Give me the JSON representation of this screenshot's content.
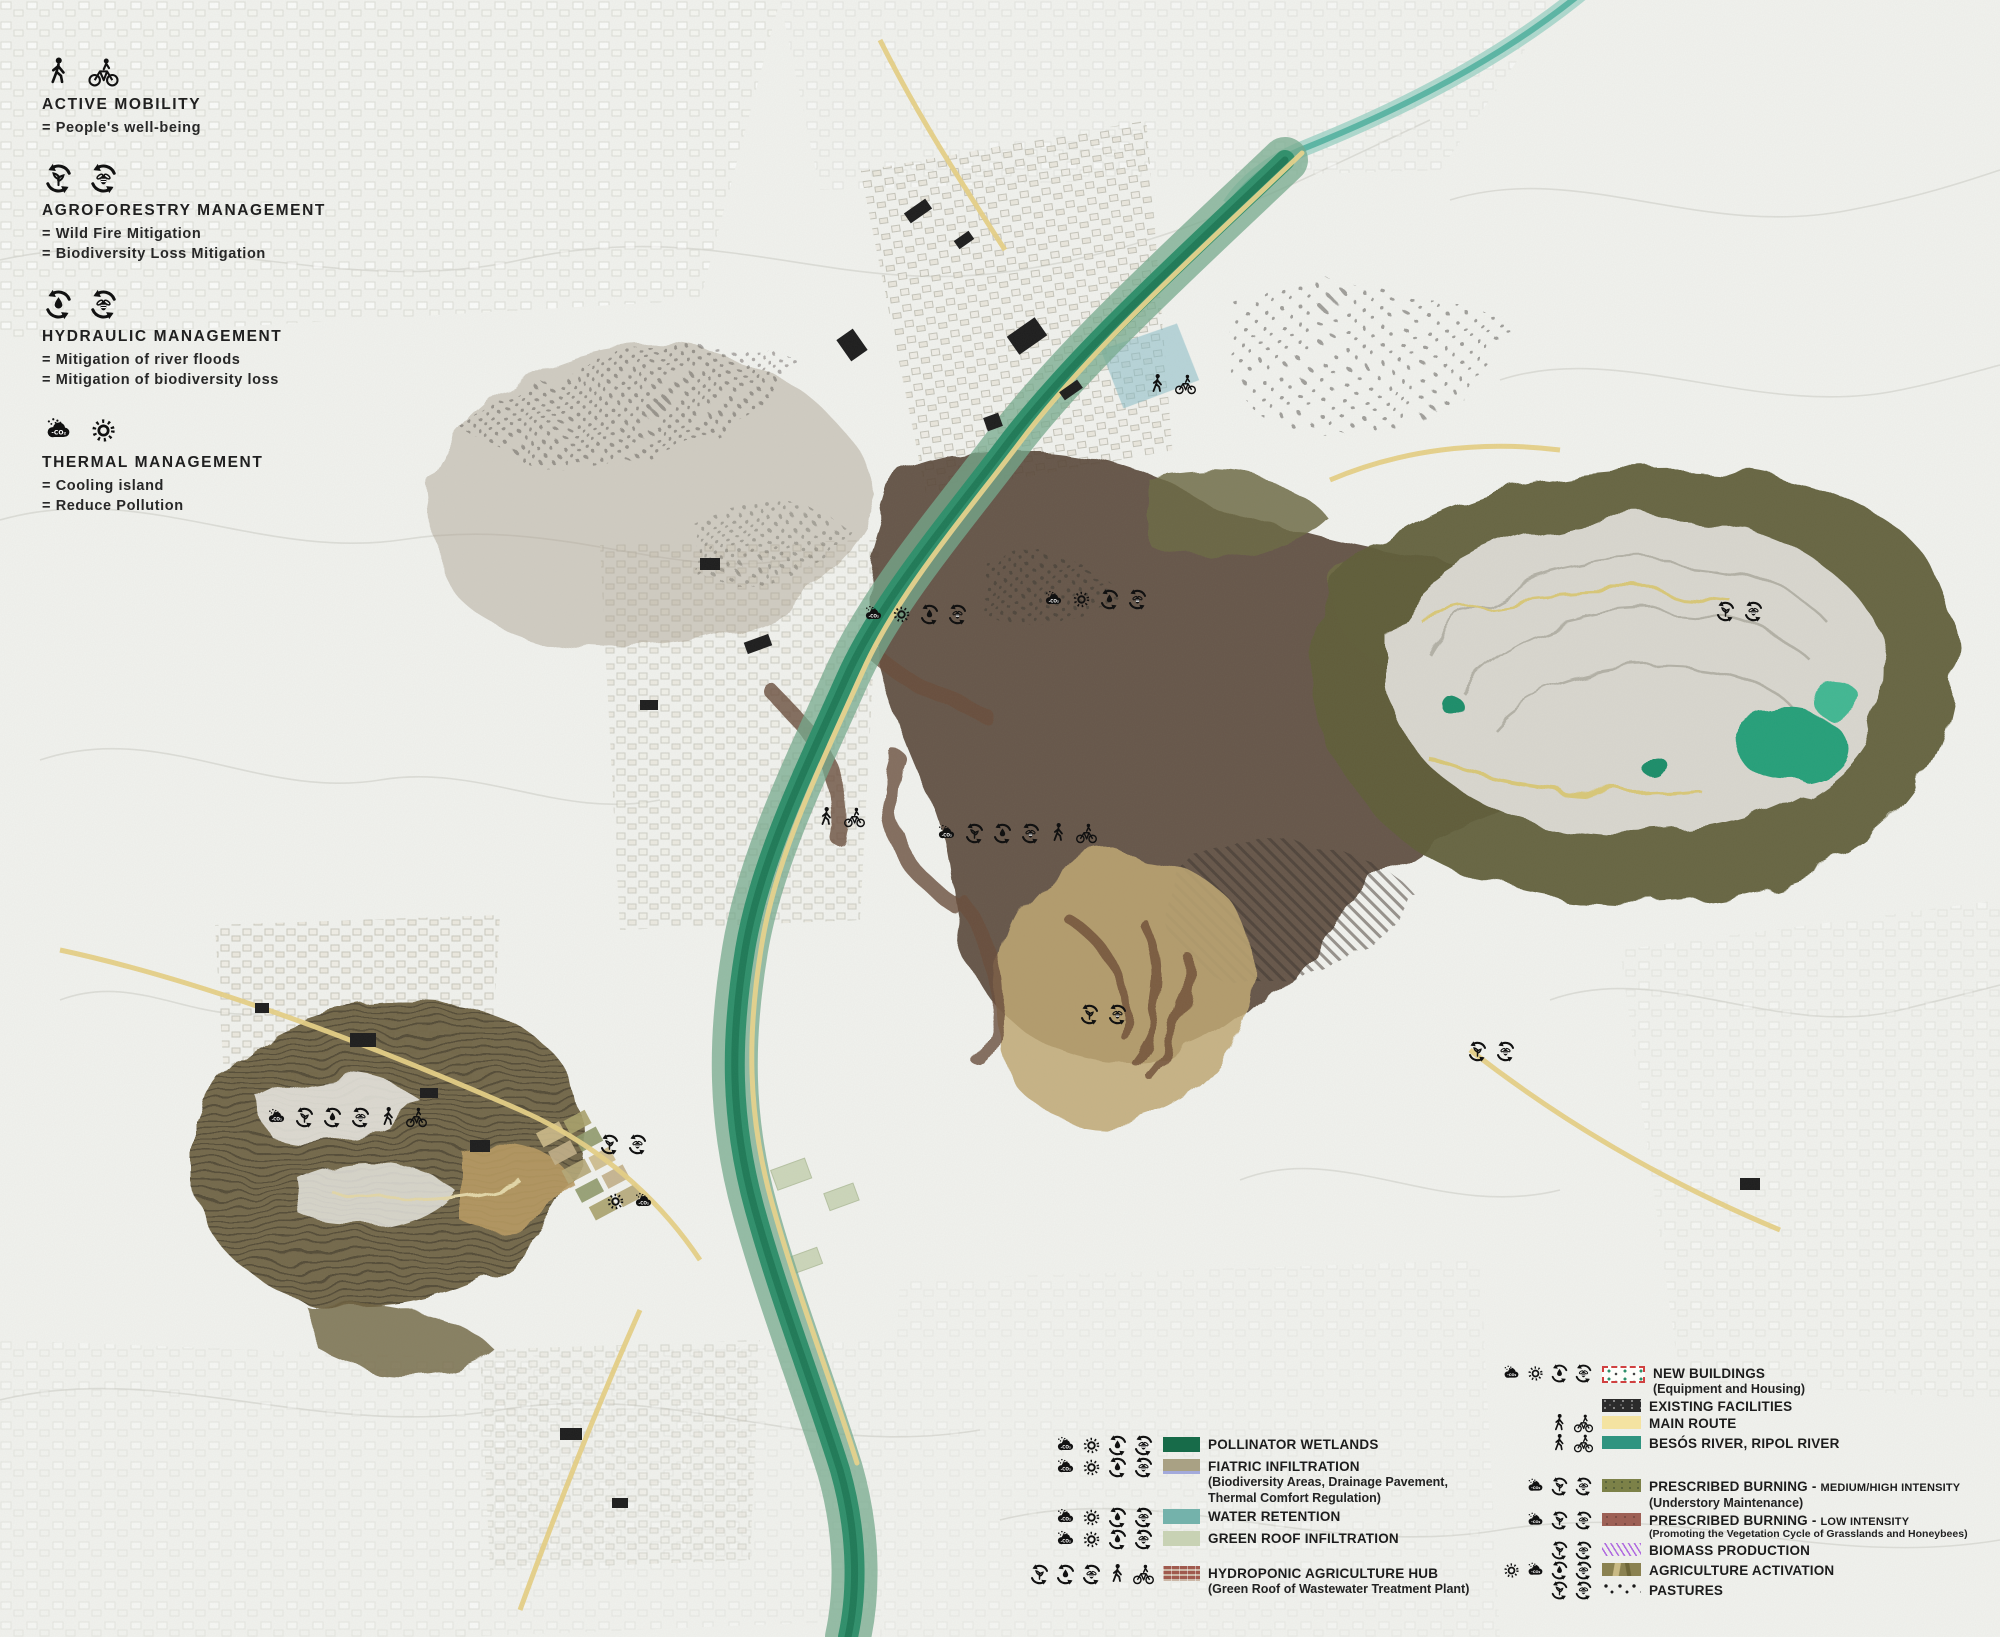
{
  "legend_topleft": {
    "sections": [
      {
        "id": "active-mobility",
        "icons": [
          "pedestrian",
          "bicycle"
        ],
        "title": "ACTIVE MOBILITY",
        "lines": [
          "= People's well-being"
        ]
      },
      {
        "id": "agroforestry-management",
        "icons": [
          "cycle-leaf",
          "cycle-bee"
        ],
        "title": "AGROFORESTRY MANAGEMENT",
        "lines": [
          "= Wild Fire Mitigation",
          "= Biodiversity Loss Mitigation"
        ]
      },
      {
        "id": "hydraulic-management",
        "icons": [
          "cycle-drop",
          "cycle-bee"
        ],
        "title": "HYDRAULIC MANAGEMENT",
        "lines": [
          "= Mitigation of river floods",
          "= Mitigation of biodiversity loss"
        ]
      },
      {
        "id": "thermal-management",
        "icons": [
          "cloud-co2",
          "sun"
        ],
        "title": "THERMAL MANAGEMENT",
        "lines": [
          "= Cooling island",
          "= Reduce Pollution"
        ]
      }
    ]
  },
  "legend_center": {
    "rows": [
      {
        "icons": [
          "cloud-co2",
          "sun",
          "cycle-drop",
          "cycle-bee"
        ],
        "swatch": "pollinator-wetlands",
        "label": "POLLINATOR WETLANDS",
        "sublines": []
      },
      {
        "icons": [
          "cloud-co2",
          "sun",
          "cycle-drop",
          "cycle-bee"
        ],
        "swatch": "fiatric-infiltration",
        "label": "FIATRIC INFILTRATION",
        "sublines": [
          "(Biodiversity Areas, Drainage Pavement,",
          "Thermal Comfort Regulation)"
        ]
      },
      {
        "icons": [
          "cloud-co2",
          "sun",
          "cycle-drop",
          "cycle-bee"
        ],
        "swatch": "water-retention",
        "label": "WATER RETENTION",
        "sublines": []
      },
      {
        "icons": [
          "cloud-co2",
          "sun",
          "cycle-drop",
          "cycle-bee"
        ],
        "swatch": "green-roof-infiltration",
        "label": "GREEN ROOF INFILTRATION",
        "sublines": []
      },
      {
        "icons": [
          "cycle-leaf",
          "cycle-drop",
          "cycle-bee",
          "pedestrian",
          "bicycle"
        ],
        "swatch": "hydroponic-agriculture-hub",
        "label": "HYDROPONIC AGRICULTURE HUB",
        "sublines": [
          "(Green Roof of Wastewater Treatment Plant)"
        ],
        "gap_before": 15
      }
    ]
  },
  "legend_right": {
    "rows": [
      {
        "icons": [
          "cloud-co2",
          "sun",
          "cycle-drop",
          "cycle-bee"
        ],
        "swatch": "new-buildings",
        "label": "NEW BUILDINGS",
        "sublines": [
          "(Equipment and Housing)"
        ]
      },
      {
        "icons": [],
        "swatch": "existing-facilities",
        "label": "EXISTING FACILITIES",
        "sublines": []
      },
      {
        "icons": [
          "pedestrian",
          "bicycle"
        ],
        "swatch": "main-route",
        "label": "MAIN ROUTE",
        "sublines": []
      },
      {
        "icons": [
          "pedestrian",
          "bicycle"
        ],
        "swatch": "besos-river",
        "label": "BESÓS RIVER, RIPOL RIVER",
        "sublines": []
      },
      {
        "icons": [
          "cloud-co2",
          "cycle-leaf",
          "cycle-bee"
        ],
        "swatch": "prescribed-burning-medium-high",
        "label": "PRESCRIBED BURNING - ",
        "label_suffix": "MEDIUM/HIGH INTENSITY",
        "sublines": [
          "(Understory Maintenance)"
        ],
        "gap_before": 25
      },
      {
        "icons": [
          "cloud-co2",
          "cycle-leaf",
          "cycle-bee"
        ],
        "swatch": "prescribed-burning-low",
        "label": "PRESCRIBED BURNING - ",
        "label_suffix": " LOW INTENSITY",
        "sublines_small": [
          "(Promoting the Vegetation Cycle of Grasslands and Honeybees)"
        ],
        "sublines": []
      },
      {
        "icons": [
          "cycle-leaf",
          "cycle-bee"
        ],
        "swatch": "biomass-production",
        "label": "BIOMASS PRODUCTION",
        "sublines": []
      },
      {
        "icons": [
          "sun",
          "cloud-co2",
          "cycle-drop",
          "cycle-bee"
        ],
        "swatch": "agriculture-activation",
        "label": "AGRICULTURE ACTIVATION",
        "sublines": []
      },
      {
        "icons": [
          "cycle-leaf",
          "cycle-bee"
        ],
        "swatch": "pastures",
        "label": "PASTURES",
        "sublines": []
      }
    ]
  },
  "swatch_colors": {
    "pollinator-wetlands": "#176b49",
    "fiatric-infiltration": "#a9a184",
    "fiatric-underline": "#a3aadb",
    "water-retention": "#74b2ab",
    "green-roof-infiltration": "#c8d2b4",
    "hydroponic-agriculture-hub-brick": "#a05a4e",
    "new-buildings-border": "#d04040",
    "existing-facilities": "#2b2b2b",
    "main-route": "#f4e3a1",
    "besos-river": "#2f9480",
    "prescribed-burning-medium-high": "#7c8148",
    "prescribed-burning-low": "#9d6055",
    "biomass-production": "#b06ae0",
    "agriculture-activation": "#8a8150",
    "pastures-dots": "#1a1a1a"
  },
  "icon_meta": {
    "cloud_co2_label": "-CO₂"
  },
  "map_icon_clusters": [
    {
      "x": 862,
      "y": 603,
      "icons": [
        "cloud-co2",
        "sun",
        "cycle-drop",
        "cycle-bee"
      ]
    },
    {
      "x": 1042,
      "y": 588,
      "icons": [
        "cloud-co2",
        "sun",
        "cycle-drop",
        "cycle-bee"
      ]
    },
    {
      "x": 935,
      "y": 822,
      "icons": [
        "cloud-co2",
        "cycle-leaf",
        "cycle-drop",
        "cycle-bee",
        "pedestrian",
        "bicycle"
      ]
    },
    {
      "x": 815,
      "y": 806,
      "icons": [
        "pedestrian",
        "bicycle"
      ]
    },
    {
      "x": 1078,
      "y": 1003,
      "icons": [
        "cycle-leaf",
        "cycle-bee"
      ]
    },
    {
      "x": 1466,
      "y": 1040,
      "icons": [
        "cycle-leaf",
        "cycle-bee"
      ]
    },
    {
      "x": 1714,
      "y": 600,
      "icons": [
        "cycle-leaf",
        "cycle-bee"
      ]
    },
    {
      "x": 265,
      "y": 1106,
      "icons": [
        "cloud-co2",
        "cycle-leaf",
        "cycle-drop",
        "cycle-bee",
        "pedestrian",
        "bicycle"
      ]
    },
    {
      "x": 598,
      "y": 1133,
      "icons": [
        "cycle-leaf",
        "cycle-bee"
      ]
    },
    {
      "x": 604,
      "y": 1190,
      "icons": [
        "sun",
        "cloud-co2"
      ]
    },
    {
      "x": 1146,
      "y": 373,
      "icons": [
        "pedestrian",
        "bicycle"
      ]
    }
  ]
}
